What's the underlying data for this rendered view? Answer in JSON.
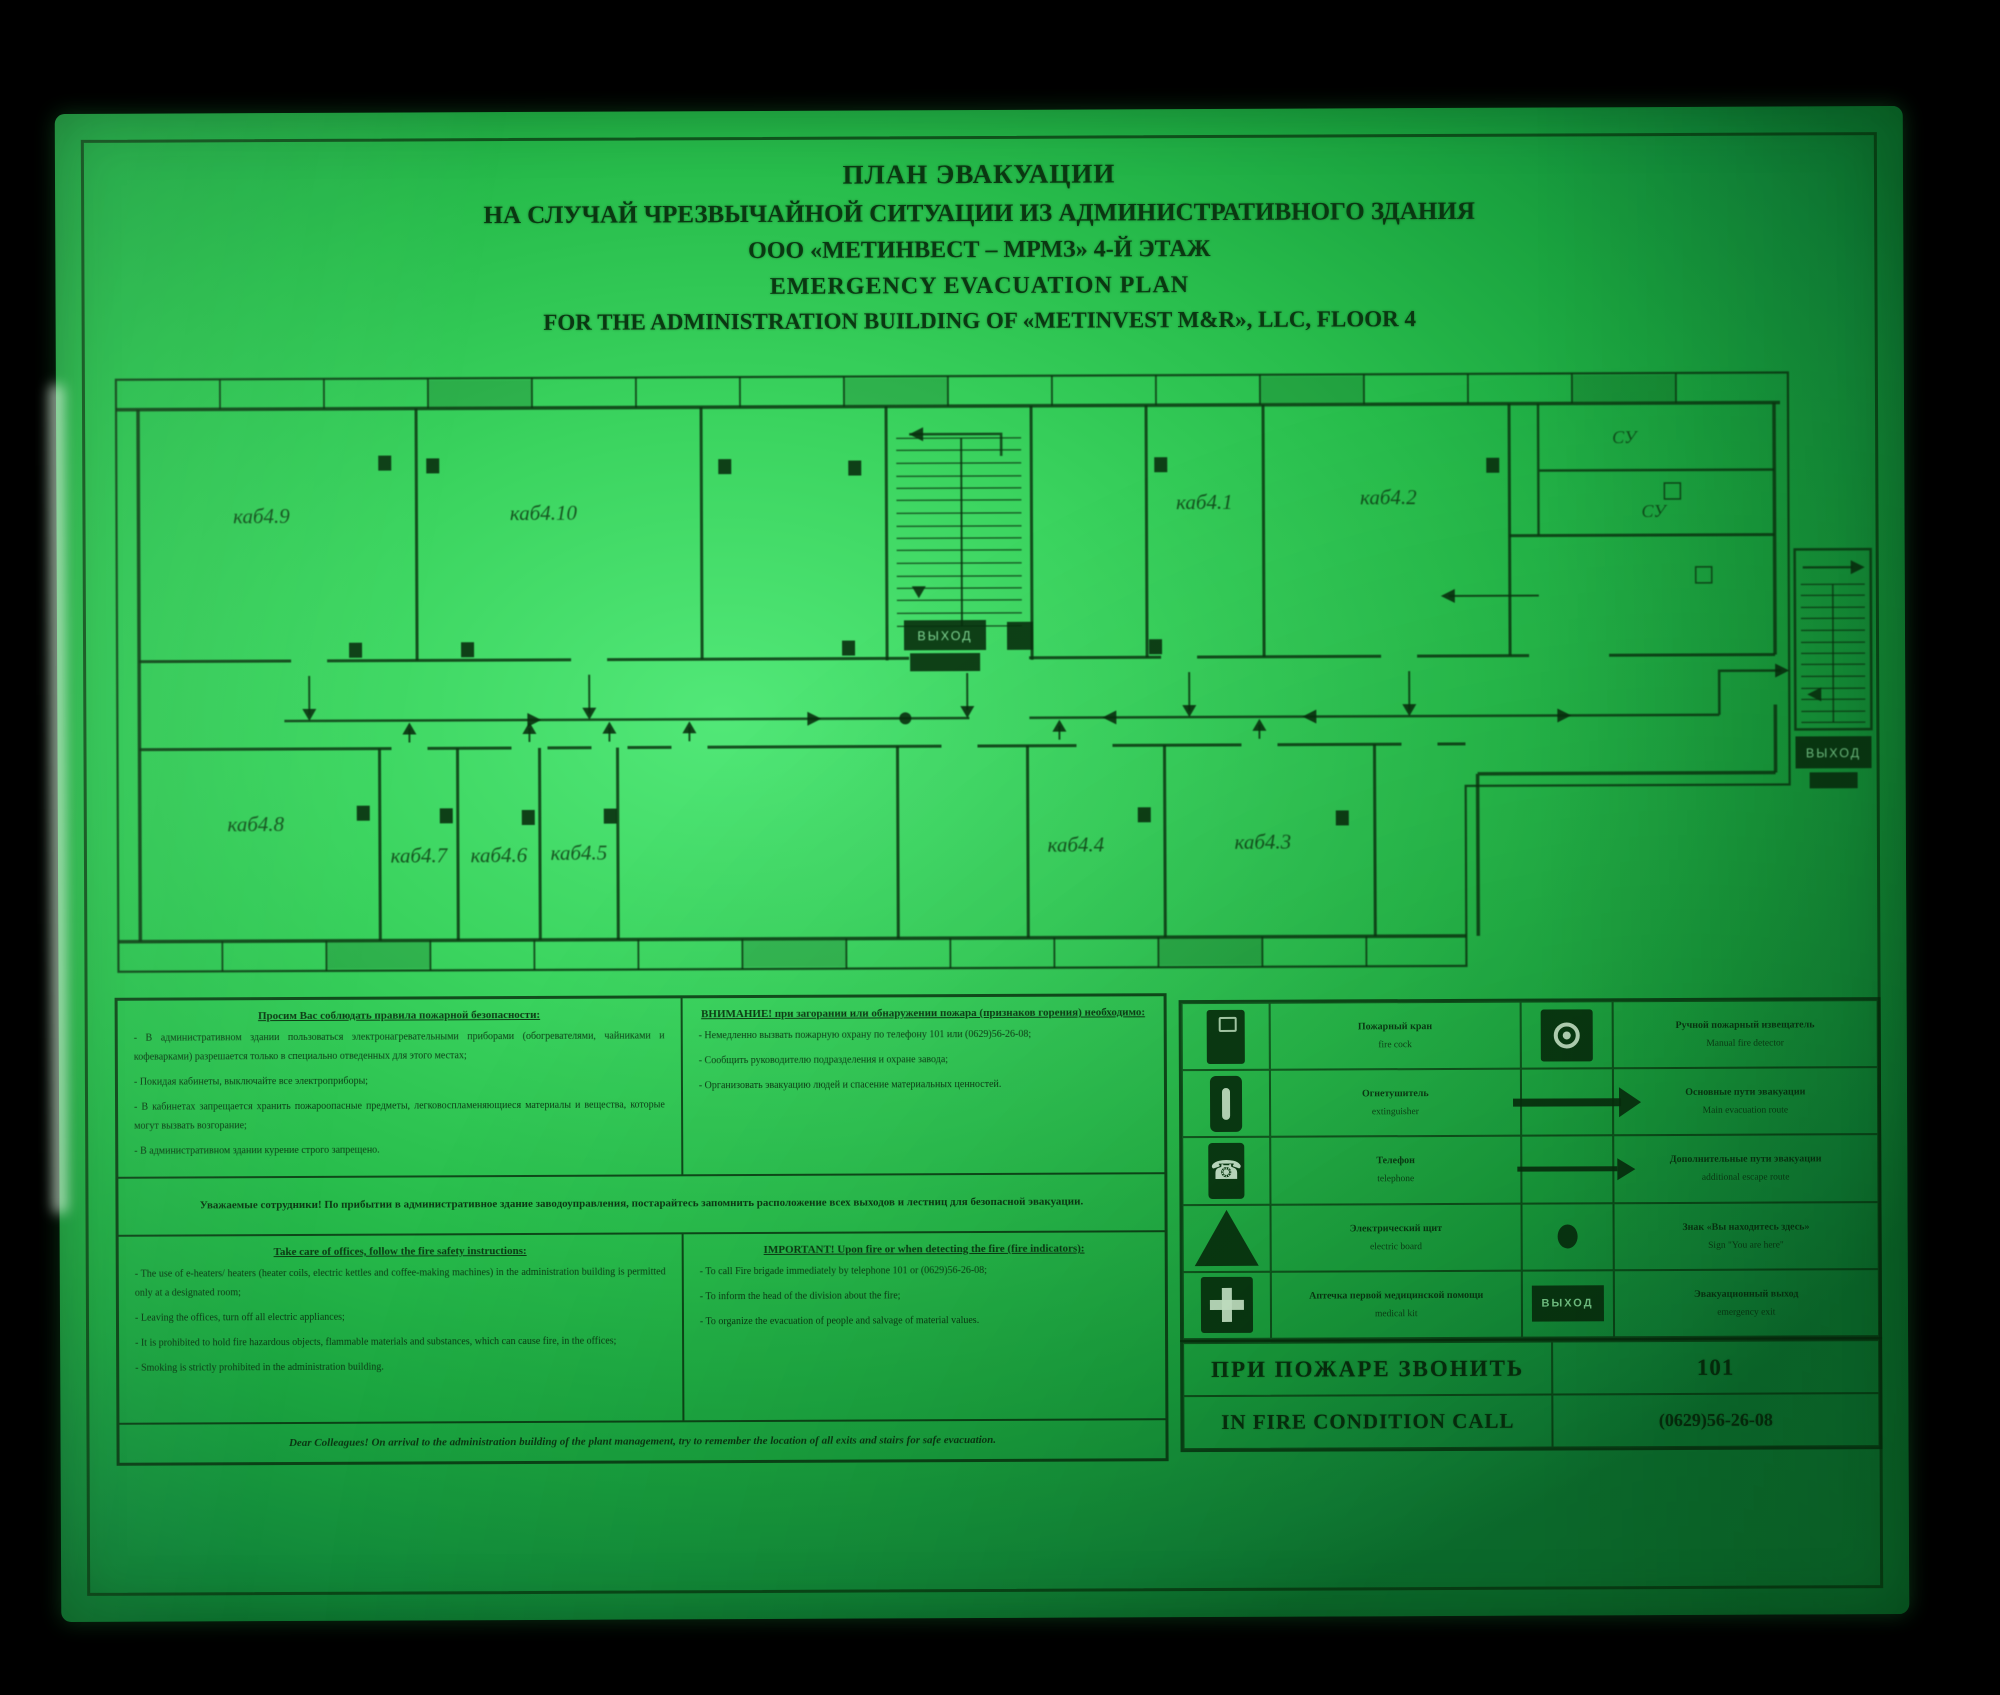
{
  "title": {
    "ru": [
      "ПЛАН ЭВАКУАЦИИ",
      "НА СЛУЧАЙ ЧРЕЗВЫЧАЙНОЙ СИТУАЦИИ ИЗ АДМИНИСТРАТИВНОГО ЗДАНИЯ",
      "ООО «МЕТИНВЕСТ – МРМЗ» 4-Й ЭТАЖ"
    ],
    "en": [
      "EMERGENCY EVACUATION PLAN",
      "FOR THE ADMINISTRATION BUILDING OF «METINVEST M&R», LLC, FLOOR 4"
    ]
  },
  "floor_plan": {
    "rooms_upper": [
      "каб4.9",
      "каб4.10",
      "каб4.1",
      "каб4.2"
    ],
    "rooms_su": [
      "СУ",
      "СУ"
    ],
    "rooms_lower": [
      "каб4.8",
      "каб4.7",
      "каб4.6",
      "каб4.5",
      "каб4.4",
      "каб4.3"
    ],
    "exit_label": "ВЫХОД"
  },
  "instructions": {
    "ru": {
      "rules": {
        "header": "Просим Вас соблюдать правила пожарной безопасности:",
        "items": [
          "- В административном здании пользоваться электронагревательными приборами (обогревателями, чайниками и кофеварками) разрешается только в специально отведенных для этого местах;",
          "- Покидая кабинеты, выключайте все электроприборы;",
          "- В кабинетах запрещается хранить пожароопасные предметы, легковоспламеняющиеся материалы и вещества, которые могут вызвать возгорание;",
          "- В административном здании курение строго запрещено."
        ]
      },
      "actions": {
        "header": "ВНИМАНИЕ! при загорании или обнаружении пожара (признаков горения) необходимо:",
        "items": [
          "- Немедленно вызвать пожарную охрану по телефону 101 или (0629)56-26-08;",
          "- Сообщить руководителю подразделения и охране завода;",
          "- Организовать эвакуацию людей и спасение материальных ценностей."
        ]
      },
      "footer": "Уважаемые сотрудники! По прибытии в административное здание заводоуправления, постарайтесь запомнить расположение всех выходов и лестниц для безопасной эвакуации."
    },
    "en": {
      "rules": {
        "header": "Take care of offices, follow the fire safety instructions:",
        "items": [
          "- The use of e-heaters/ heaters (heater coils, electric kettles and coffee-making machines) in the administration building is permitted only at a designated room;",
          "- Leaving the offices, turn off all electric appliances;",
          "- It is prohibited to hold fire hazardous objects, flammable materials and substances, which can cause fire, in the offices;",
          "- Smoking is strictly prohibited in the administration building."
        ]
      },
      "actions": {
        "header": "IMPORTANT! Upon fire or when detecting the fire (fire indicators):",
        "items": [
          "- To call Fire brigade immediately by telephone 101 or (0629)56-26-08;",
          "- To inform the head of the division about the fire;",
          "- To organize the evacuation of people and salvage of material values."
        ]
      },
      "footer": "Dear Colleagues! On arrival to the administration building of the plant management, try to remember the location of all exits and stairs for safe evacuation."
    }
  },
  "legend": {
    "rows": [
      {
        "left": {
          "icon": "fire-hose-cabinet",
          "ru": "Пожарный кран",
          "en": "fire cock"
        },
        "right": {
          "icon": "manual-call-point",
          "ru": "Ручной пожарный извещатель",
          "en": "Manual fire detector"
        }
      },
      {
        "left": {
          "icon": "fire-extinguisher",
          "ru": "Огнетушитель",
          "en": "extinguisher"
        },
        "right": {
          "icon": "arrow-solid",
          "ru": "Основные пути эвакуации",
          "en": "Main evacuation route"
        }
      },
      {
        "left": {
          "icon": "telephone",
          "ru": "Телефон",
          "en": "telephone"
        },
        "right": {
          "icon": "arrow-open",
          "ru": "Дополнительные пути эвакуации",
          "en": "additional escape route"
        }
      },
      {
        "left": {
          "icon": "electric-board",
          "ru": "Электрический щит",
          "en": "electric board"
        },
        "right": {
          "icon": "you-are-here-dot",
          "ru": "Знак «Вы находитесь здесь»",
          "en": "Sign \"You are here\""
        }
      },
      {
        "left": {
          "icon": "first-aid-kit",
          "ru": "Аптечка первой медицинской помощи",
          "en": "medical kit"
        },
        "right": {
          "icon": "exit-sign",
          "ru": "Эвакуационный выход",
          "en": "emergency exit"
        }
      }
    ]
  },
  "fire_call": {
    "ru_label": "ПРИ ПОЖАРЕ  ЗВОНИТЬ",
    "ru_number": "101",
    "en_label": "IN FIRE CONDITION CALL",
    "en_number": "(0629)56-26-08"
  },
  "colors": {
    "plate_green": "#2fc553",
    "ink_dark": "#0b3511",
    "glow_text": "#7fd692"
  }
}
